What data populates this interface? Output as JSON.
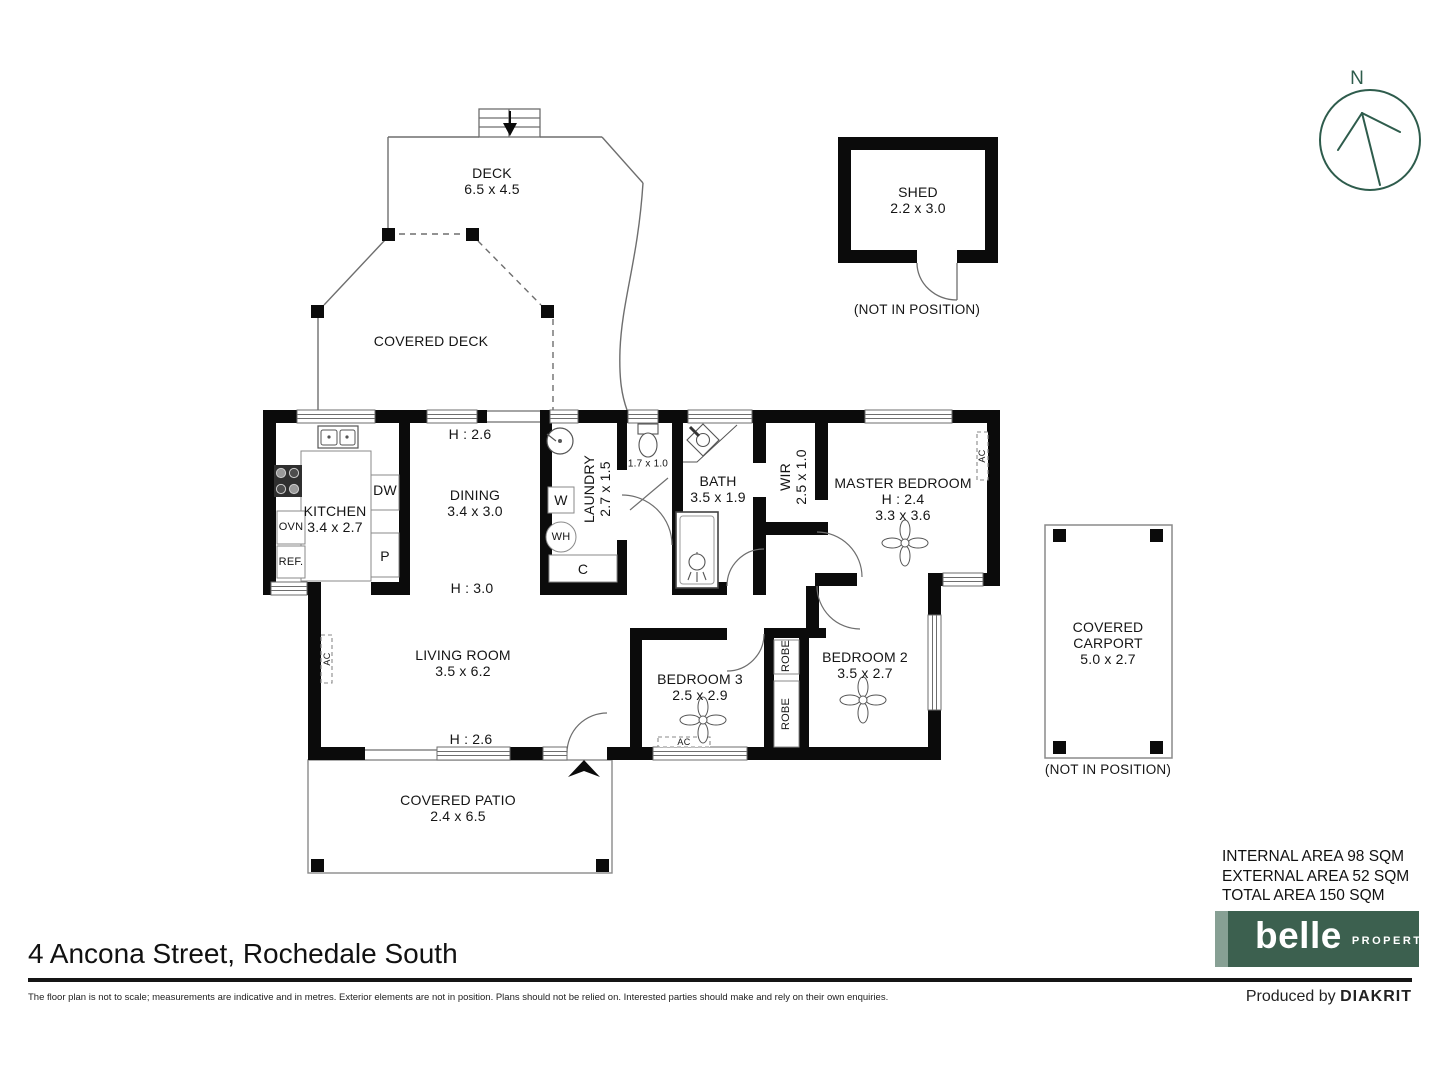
{
  "header": {
    "address": "4 Ancona Street, Rochedale South"
  },
  "compass": {
    "north": "N"
  },
  "notes": {
    "not_in_position": "(NOT IN POSITION)"
  },
  "heights": {
    "upper": "H : 2.6",
    "living": "H : 3.0",
    "lower": "H : 2.6"
  },
  "rooms": {
    "deck": {
      "name": "DECK",
      "dim": "6.5 x 4.5"
    },
    "covered_deck": {
      "name": "COVERED DECK"
    },
    "shed": {
      "name": "SHED",
      "dim": "2.2 x 3.0"
    },
    "kitchen": {
      "name": "KITCHEN",
      "dim": "3.4 x 2.7"
    },
    "dining": {
      "name": "DINING",
      "dim": "3.4 x 3.0"
    },
    "laundry": {
      "name": "LAUNDRY",
      "dim": "2.7 x 1.5"
    },
    "wc": {
      "dim": "1.7 x 1.0"
    },
    "bath": {
      "name": "BATH",
      "dim": "3.5 x 1.9"
    },
    "wir": {
      "name": "WIR",
      "dim": "2.5 x 1.0"
    },
    "master": {
      "name": "MASTER BEDROOM",
      "height": "H : 2.4",
      "dim": "3.3 x 3.6"
    },
    "living": {
      "name": "LIVING ROOM",
      "dim": "3.5 x 6.2"
    },
    "bedroom3": {
      "name": "BEDROOM 3",
      "dim": "2.5 x 2.9"
    },
    "bedroom2": {
      "name": "BEDROOM 2",
      "dim": "3.5 x 2.7"
    },
    "patio": {
      "name": "COVERED PATIO",
      "dim": "2.4 x 6.5"
    },
    "carport": {
      "line1": "COVERED",
      "line2": "CARPORT",
      "dim": "5.0 x 2.7"
    }
  },
  "fixtures": {
    "dw": "DW",
    "p": "P",
    "w": "W",
    "wh": "WH",
    "c": "C",
    "ovn": "OVN",
    "ref": "REF.",
    "robe": "ROBE",
    "ac": "AC"
  },
  "areas": {
    "internal": "INTERNAL AREA 98 SQM",
    "external": "EXTERNAL AREA 52 SQM",
    "total": "TOTAL AREA 150 SQM"
  },
  "brand": {
    "name": "belle",
    "tagline": "PROPERTY"
  },
  "footer": {
    "disclaimer": "The floor plan is not to scale; measurements are indicative and in metres. Exterior elements are not in position. Plans should not be relied on. Interested parties should make and rely on their own enquiries.",
    "produced_by": "Produced by",
    "producer": "DIAKRIT"
  },
  "colors": {
    "wall": "#0b0b0b",
    "thin_line": "#6e6e6e",
    "compass_green": "#2e5c4c",
    "brand_green": "#3c604f",
    "brand_strip": "#87a094"
  }
}
